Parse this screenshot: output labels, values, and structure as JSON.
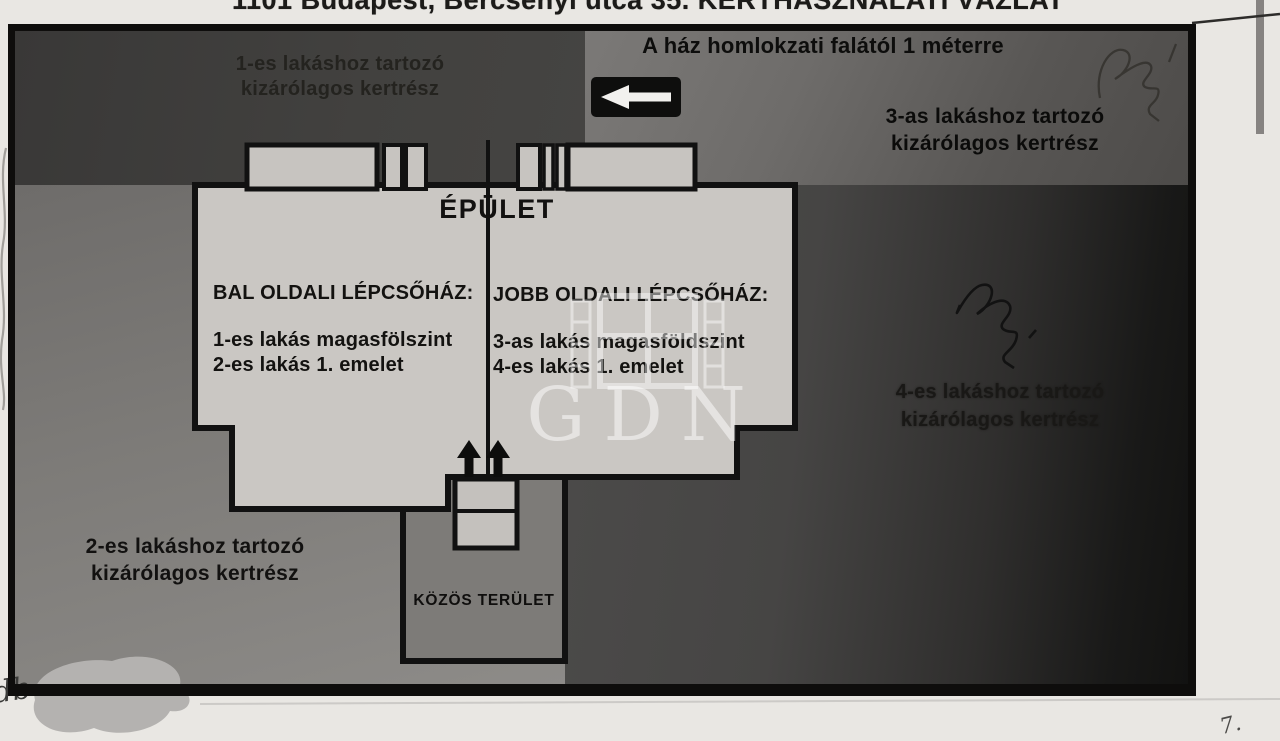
{
  "page": {
    "title_partial": "1101 Budapest, Bercsényi utca 35. KERTHASZNÁLATI VÁZLAT"
  },
  "legend": {
    "facade_note": "A ház homlokzati falától 1 méterre"
  },
  "gardens": {
    "g1": {
      "line1": "1-es lakáshoz tartozó",
      "line2": "kizárólagos kertrész"
    },
    "g2": {
      "line1": "2-es lakáshoz tartozó",
      "line2": "kizárólagos kertrész"
    },
    "g3": {
      "line1": "3-as lakáshoz tartozó",
      "line2": "kizárólagos kertrész"
    },
    "g4": {
      "line1": "4-es lakáshoz tartozó",
      "line2": "kizárólagos kertrész"
    }
  },
  "building": {
    "title": "ÉPÜLET",
    "left_stairwell": {
      "heading": "BAL OLDALI LÉPCSŐHÁZ:",
      "line1": "1-es lakás magasfölszint",
      "line2": "2-es lakás 1. emelet"
    },
    "right_stairwell": {
      "heading": "JOBB OLDALI LÉPCSŐHÁZ:",
      "line1": "3-as lakás magasföldszint",
      "line2": "4-es lakás 1. emelet"
    }
  },
  "common_area": {
    "label": "KÖZÖS TERÜLET"
  },
  "watermark": {
    "text": "GDN"
  },
  "handwriting": {
    "bottom_left": "db",
    "bottom_right_mark": "7."
  },
  "colors": {
    "paper": "#e9e7e3",
    "ink": "#111111",
    "dark_region": "#3f3e3d",
    "medium_region": "#7b7977",
    "building_fill": "#cac7c3",
    "watermark_white": "#ffffff"
  }
}
